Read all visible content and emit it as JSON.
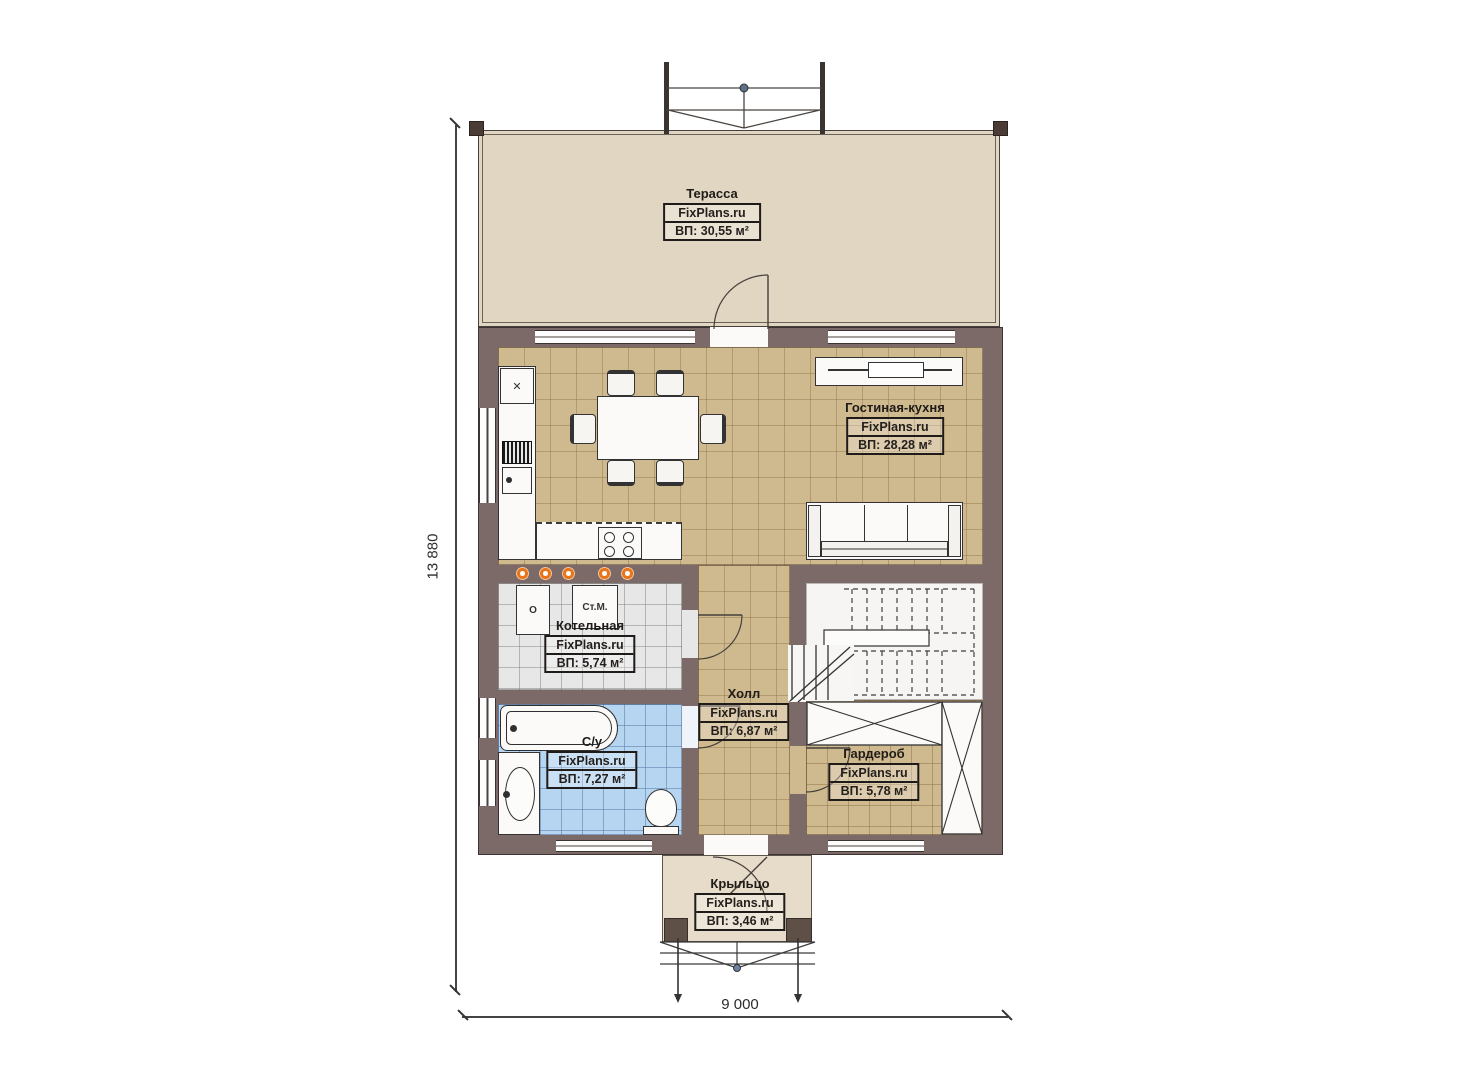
{
  "watermark": "FixPlans.ru",
  "dimensions": {
    "height": "13 880",
    "width": "9 000"
  },
  "rooms": {
    "terrace": {
      "name": "Терасса",
      "area": "ВП: 30,55 м²"
    },
    "living": {
      "name": "Гостиная-кухня",
      "area": "ВП: 28,28 м²"
    },
    "boiler": {
      "name": "Котельная",
      "area": "ВП: 5,74 м²"
    },
    "hall": {
      "name": "Холл",
      "area": "ВП: 6,87 м²"
    },
    "bath": {
      "name": "С/у",
      "area": "ВП: 7,27 м²"
    },
    "wardrobe": {
      "name": "Гардероб",
      "area": "ВП: 5,78 м²"
    },
    "porch": {
      "name": "Крыльцо",
      "area": "ВП: 3,46 м²"
    }
  },
  "appliances": {
    "washing_machine": "Ст.М.",
    "boiler_unit": "О"
  },
  "icons": {
    "corner_cabinet_x": "✕"
  },
  "colors": {
    "wall": "#7c6a68",
    "terrace_floor": "#e1d6c1",
    "living_floor": "#cfb98e",
    "boiler_floor": "#e7e7e7",
    "bath_floor": "#b6d5f0",
    "porch_floor": "#e6dcc9",
    "accent_dot": "#e8741c"
  }
}
